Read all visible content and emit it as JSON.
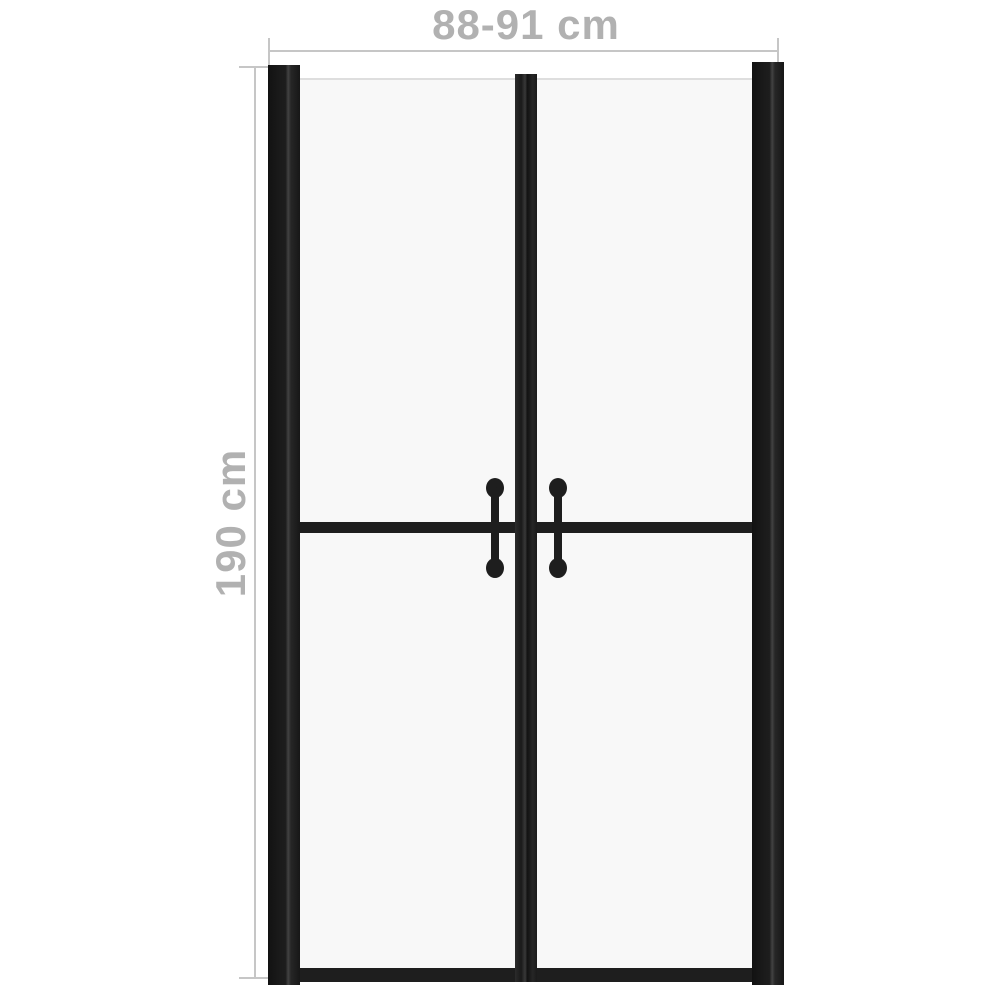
{
  "diagram": {
    "width_label": "88-91 cm",
    "height_label": "190 cm"
  },
  "colors": {
    "background": "#ffffff",
    "frame": "#1e1e1e",
    "glass": "#f8f8f8",
    "glass_edge": "#dedede",
    "dimension_line": "#c6c6c6",
    "dimension_text": "#b1b1b1"
  }
}
